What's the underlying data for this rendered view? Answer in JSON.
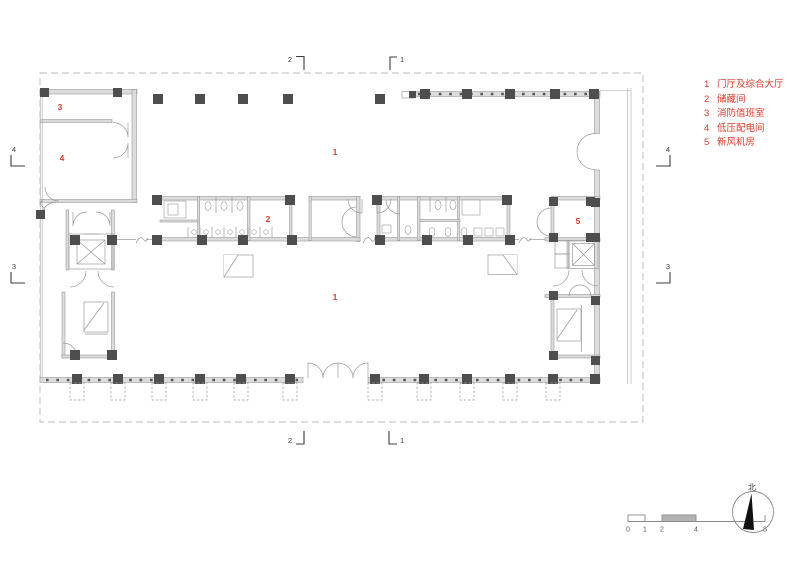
{
  "legend": {
    "items": [
      {
        "num": "1",
        "label": "门厅及综合大厅"
      },
      {
        "num": "2",
        "label": "储藏间"
      },
      {
        "num": "3",
        "label": "消防值班室"
      },
      {
        "num": "4",
        "label": "低压配电间"
      },
      {
        "num": "5",
        "label": "新风机房"
      }
    ]
  },
  "room_labels": {
    "hall_top": "1",
    "hall_bottom": "1",
    "storage": "2",
    "fire_duty_room": "3",
    "power_room": "4",
    "fresh_air_room": "5"
  },
  "section_markers": {
    "top_left": "2",
    "top_right": "1",
    "bottom_left": "2",
    "bottom_right": "1",
    "left_upper": "4",
    "left_lower": "3",
    "right_upper": "4",
    "right_lower": "3"
  },
  "scale_bar": {
    "ticks": [
      "0",
      "1",
      "2",
      "4",
      "8"
    ]
  },
  "north_arrow": {
    "label": "北"
  },
  "colors": {
    "annotation_red": "#e0392b",
    "wall_fill": "#dcdcdc",
    "column_gray": "#4e4e4e"
  }
}
